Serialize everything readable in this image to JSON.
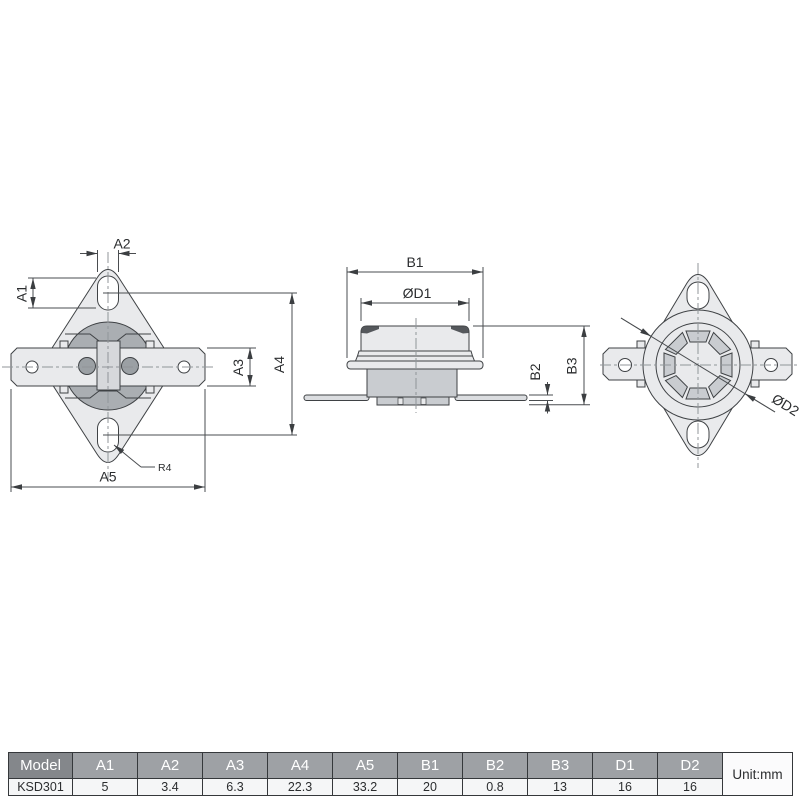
{
  "drawing": {
    "views": {
      "front": {
        "labels": {
          "a1": "A1",
          "a2": "A2",
          "a3": "A3",
          "a4": "A4",
          "a5": "A5",
          "r4": "R4"
        }
      },
      "side": {
        "labels": {
          "b1": "B1",
          "d1": "ØD1",
          "b2": "B2",
          "b3": "B3"
        }
      },
      "back": {
        "labels": {
          "d2": "ØD2"
        }
      }
    }
  },
  "table": {
    "columns": [
      "Model",
      "A1",
      "A2",
      "A3",
      "A4",
      "A5",
      "B1",
      "B2",
      "B3",
      "D1",
      "D2"
    ],
    "unit_label": "Unit:mm",
    "rows": [
      [
        "KSD301",
        "5",
        "3.4",
        "6.3",
        "22.3",
        "33.2",
        "20",
        "0.8",
        "13",
        "16",
        "16"
      ]
    ]
  },
  "colors": {
    "part_fill_light": "#e9eaec",
    "part_fill_medium": "#c9ccd0",
    "part_fill_dark": "#aaaeb2",
    "drawing_line": "#3f4245",
    "header_bg": "#9ea1a5",
    "model_header_bg": "#84878b",
    "table_text": "#2b2d2f"
  }
}
